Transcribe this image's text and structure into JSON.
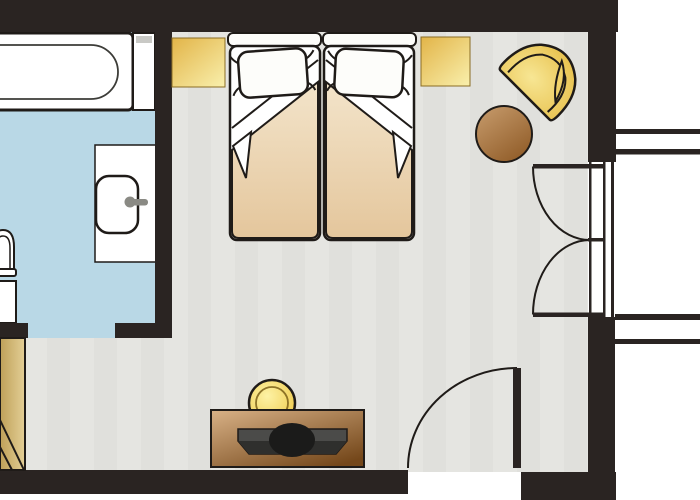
{
  "document": {
    "type": "floor-plan",
    "title": "Hotel room floor plan with twin beds, bathroom and balcony"
  },
  "colors": {
    "wall": "#2a2422",
    "white": "#ffffff",
    "linen": "#fdfdfa",
    "bedroom_floor": "#e5e5e1",
    "bathroom_floor": "#b9d8e6",
    "ledge_gray": "#c9c9c5",
    "tap_gray": "#8a8a84",
    "gold_dark": "#e2b448",
    "gold_light": "#f8eda8",
    "spread_light": "#f3e4ca",
    "spread_dark": "#e4c69c",
    "chair_light": "#f7e694",
    "chair_dark": "#e4b83c",
    "chair_mid": "#f0d269",
    "table_light": "#c89d6e",
    "table_dark": "#935f2b",
    "dresser_light": "#d9b287",
    "dresser_dark": "#74471a",
    "lamp_light": "#fdf2a5",
    "lamp_dark": "#ecc33c",
    "wardrobe_light": "#e3cf96",
    "wardrobe_dark": "#bfa058",
    "tv_gray": "#4b4b49",
    "tv_dark": "#2f2f2d",
    "tv_black": "#1b1b1a"
  },
  "rooms": [
    {
      "name": "bathroom"
    },
    {
      "name": "bedroom"
    },
    {
      "name": "balcony"
    }
  ],
  "fixtures": [
    {
      "name": "bathtub"
    },
    {
      "name": "tub-ledge"
    },
    {
      "name": "washbasin-counter"
    },
    {
      "name": "washbasin"
    },
    {
      "name": "faucet"
    },
    {
      "name": "toilet"
    },
    {
      "name": "wardrobe"
    },
    {
      "name": "nightstand-left"
    },
    {
      "name": "nightstand-right"
    },
    {
      "name": "single-bed-left"
    },
    {
      "name": "single-bed-right"
    },
    {
      "name": "pillow-left"
    },
    {
      "name": "pillow-right"
    },
    {
      "name": "armchair"
    },
    {
      "name": "round-table"
    },
    {
      "name": "dresser"
    },
    {
      "name": "table-lamp"
    },
    {
      "name": "television"
    },
    {
      "name": "entry-door"
    },
    {
      "name": "balcony-double-door"
    },
    {
      "name": "bathroom-doorway"
    },
    {
      "name": "balcony-walls"
    }
  ]
}
